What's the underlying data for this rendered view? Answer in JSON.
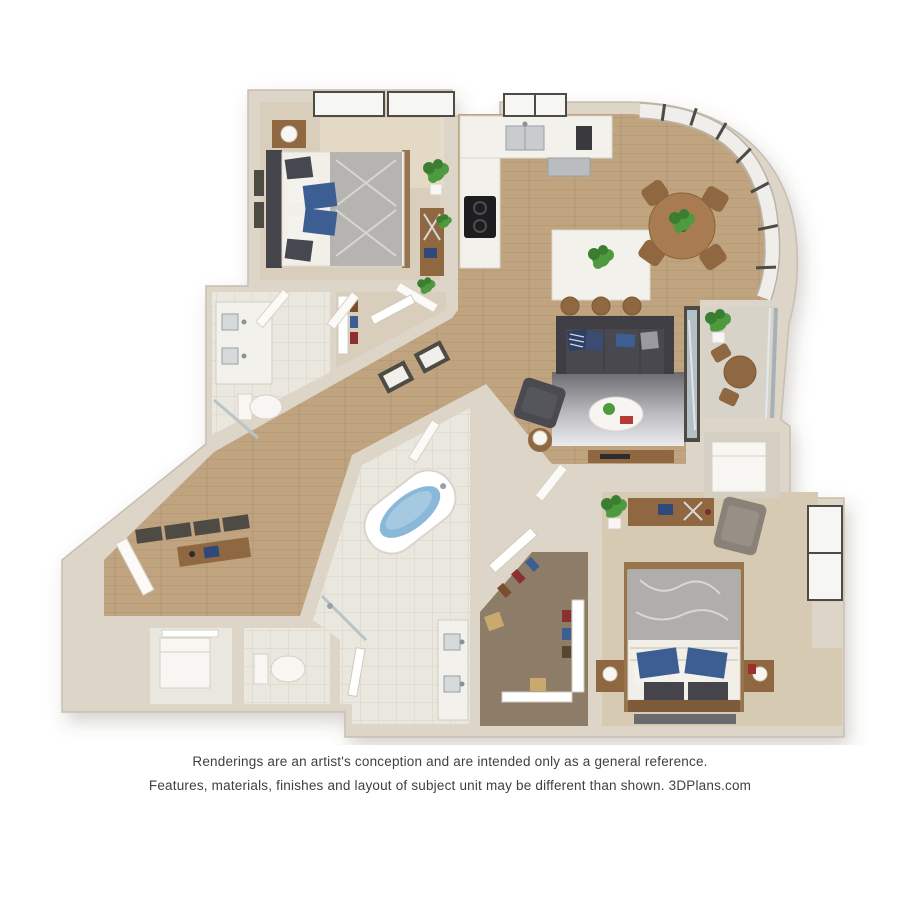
{
  "page": {
    "background": "#ffffff"
  },
  "disclaimer": {
    "line1": "Renderings are an artist's conception and are intended only as a general reference.",
    "line2": "Features, materials, finishes and layout of subject unit may be different than shown. 3DPlans.com"
  },
  "floorplan": {
    "type": "3d-rendered-floor-plan",
    "rooms": [
      "bedroom-1",
      "bathroom-1",
      "closet-1",
      "hallway",
      "entry",
      "kitchen",
      "dining-area",
      "living-room",
      "balcony",
      "storage-closet",
      "laundry-closet",
      "powder-room",
      "master-bathroom",
      "walk-in-closet",
      "bedroom-2"
    ],
    "colors": {
      "page": "#ffffff",
      "wall": "#ddd5c8",
      "wall_edge": "#c7beb0",
      "wood": "#bfa47f",
      "carpet": "#d9cebb",
      "carpet2": "#d6cab2",
      "tile": "#eae7df",
      "closet_floor": "#8d7d68",
      "marble": "#f2f1ec",
      "stainless": "#b9bdbf",
      "sofa": "#48484e",
      "accent_blue": "#3d5e92",
      "tub_water": "#8ab8d8",
      "plant": "#4e9a3f",
      "plant_dark": "#3b7d31",
      "wood_furniture": "#8f6740",
      "glass": "#b3c0c5",
      "frame_dark": "#4e4a44",
      "white_fixture": "#f7f6f3"
    }
  }
}
